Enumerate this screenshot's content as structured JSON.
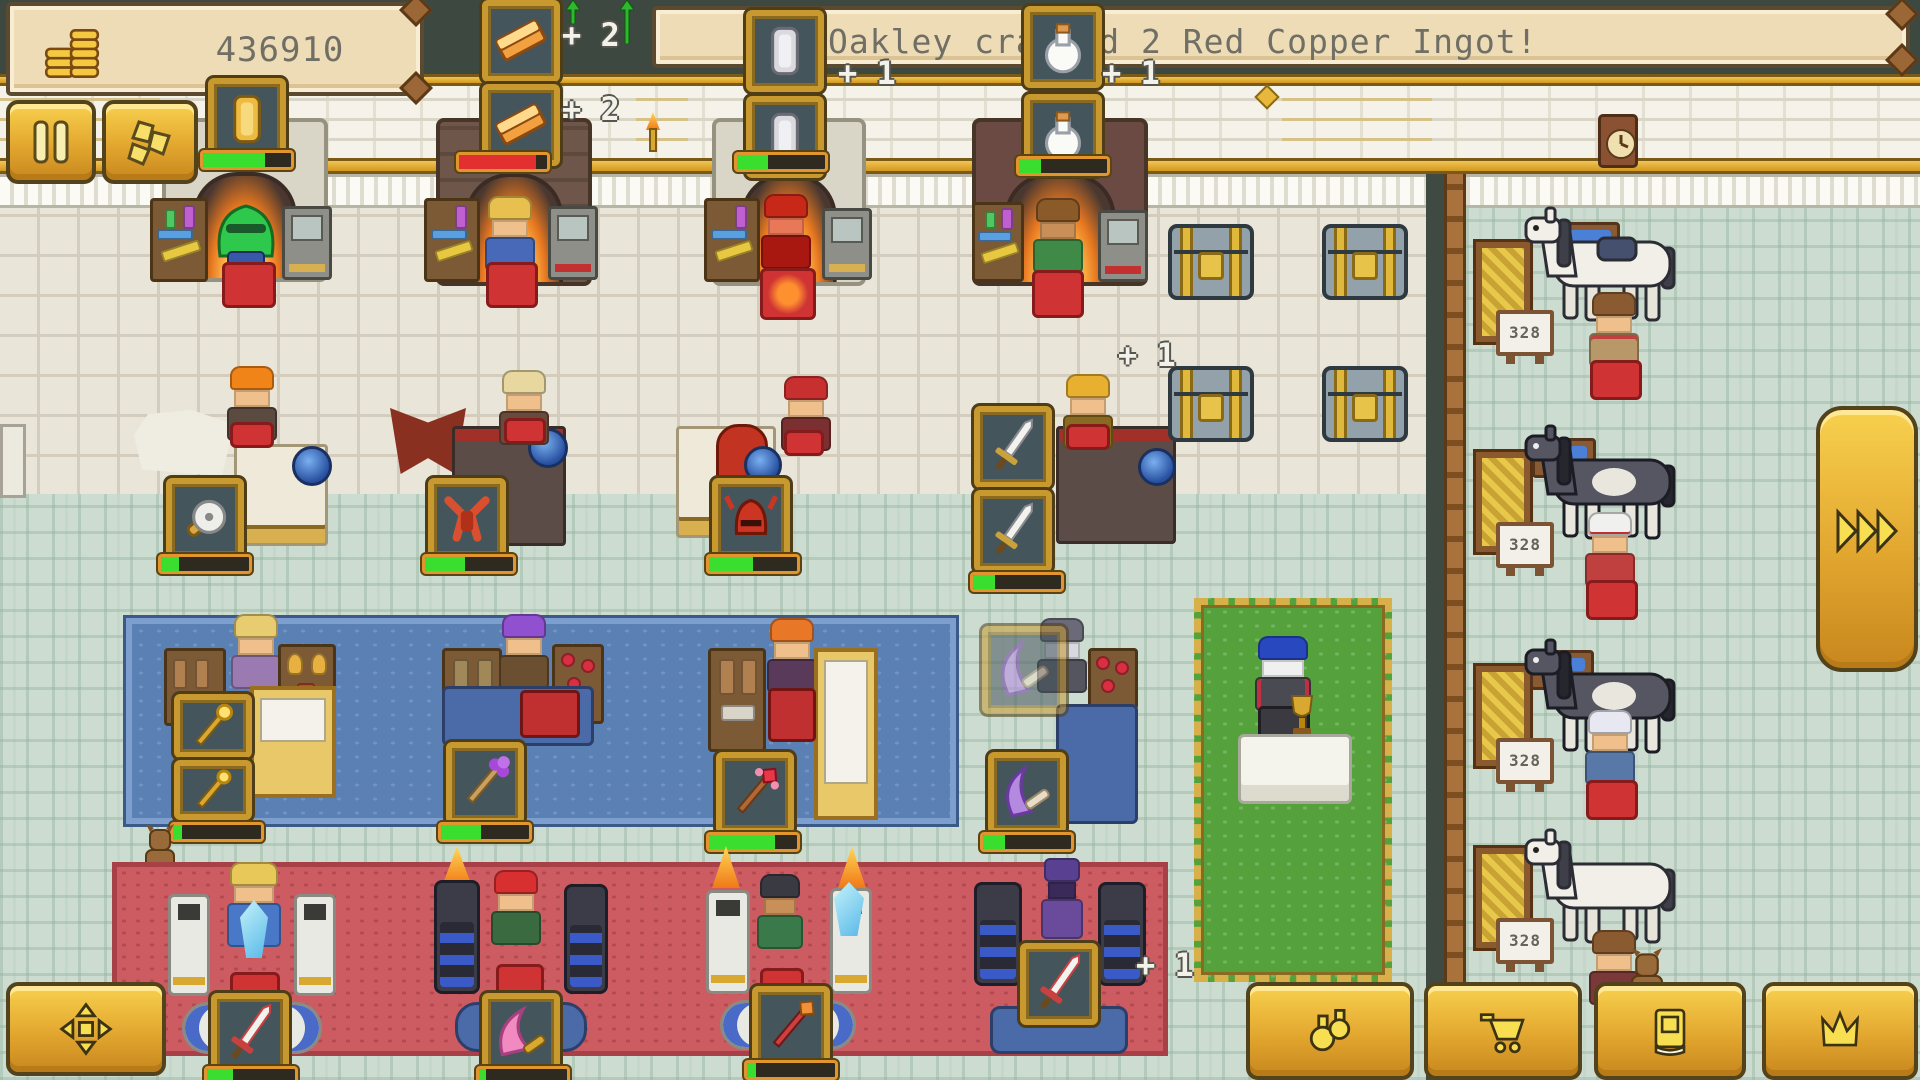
{
  "hud": {
    "money": "436910",
    "notification": "Oakley crafted 2 Red Copper Ingot!"
  },
  "popups": {
    "smelter2_top": "+ 2",
    "smelter2_bottom": "+ 2",
    "smelter3": "+ 1",
    "smelter4": "+ 1",
    "bench4": "+ 1",
    "enchant4": "+ 1"
  },
  "stations": {
    "smelters": [
      {
        "name": "smelter-gold-bar",
        "item_icon": "gold-bar-icon",
        "progress": 70,
        "bar": "green"
      },
      {
        "name": "smelter-red-copper-ingot",
        "item_icon": "copper-ingot-icon",
        "progress": 88,
        "bar": "red"
      },
      {
        "name": "smelter-silver-bar",
        "item_icon": "silver-bar-icon",
        "progress": 35,
        "bar": "green"
      },
      {
        "name": "smelter-flask",
        "item_icon": "flask-icon",
        "progress": 25,
        "bar": "green"
      }
    ],
    "benches": [
      {
        "name": "bench-saw-blade",
        "item_icon": "saw-blade-icon",
        "progress": 20,
        "bar": "green"
      },
      {
        "name": "bench-red-armor",
        "item_icon": "red-armor-icon",
        "progress": 45,
        "bar": "green"
      },
      {
        "name": "bench-red-helmet",
        "item_icon": "red-helmet-icon",
        "progress": 50,
        "bar": "green"
      },
      {
        "name": "bench-sword",
        "item_icon": "white-sword-icon",
        "progress": 25,
        "bar": "green"
      }
    ],
    "magic": [
      {
        "name": "magic-gold-scepter",
        "item_icon": "gold-scepter-icon",
        "progress": 10,
        "bar": "green"
      },
      {
        "name": "magic-purple-wand",
        "item_icon": "purple-wand-icon",
        "progress": 45,
        "bar": "green"
      },
      {
        "name": "magic-red-wand",
        "item_icon": "red-wand-icon",
        "progress": 75,
        "bar": "green"
      },
      {
        "name": "magic-purple-bow",
        "item_icon": "purple-bow-icon",
        "progress": 25,
        "bar": "green"
      }
    ],
    "enchanters": [
      {
        "name": "enchant-white-sword",
        "item_icon": "white-sword-icon",
        "progress": 30,
        "bar": "green"
      },
      {
        "name": "enchant-pink-blade",
        "item_icon": "pink-blade-icon",
        "progress": 8,
        "bar": "green"
      },
      {
        "name": "enchant-red-staff",
        "item_icon": "red-staff-icon",
        "progress": 10,
        "bar": "green"
      },
      {
        "name": "enchant-rocket-sword",
        "item_icon": "white-sword-icon",
        "progress": 0,
        "bar": "green"
      }
    ]
  },
  "stable": {
    "stalls": [
      {
        "sign": "328"
      },
      {
        "sign": "328"
      },
      {
        "sign": "328"
      },
      {
        "sign": "328"
      }
    ]
  },
  "buttons": {
    "pause": "pause-icon",
    "resources": "ore-pile-icon",
    "fast_forward": "triple-chevron-icon",
    "move": "move-arrows-icon",
    "potions": "flasks-icon",
    "shop": "cart-icon",
    "journal": "book-icon",
    "ranking": "crown-icon"
  },
  "colors": {
    "gold": "#e8b23c",
    "progress_green": "#3ade2e",
    "progress_red": "#e23030",
    "carpet_blue": "#5b80b4",
    "carpet_red": "#cc5c62",
    "carpet_green": "#55a23c"
  }
}
